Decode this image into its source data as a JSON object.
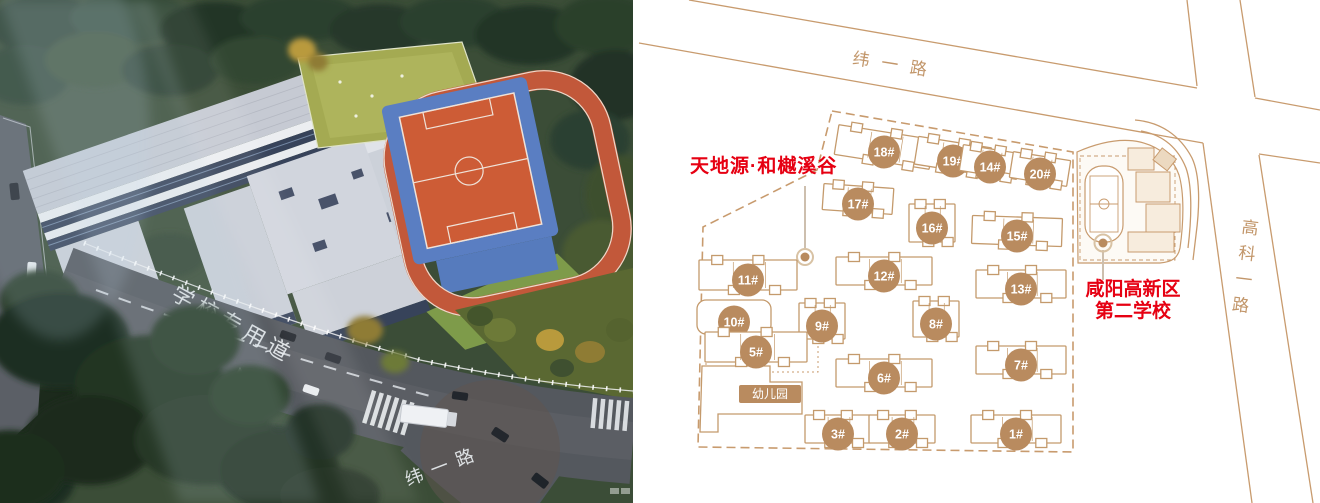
{
  "photo": {
    "road_label_main": "学校专用道",
    "road_label_bottom": "纬一路"
  },
  "plan": {
    "road_top_label": "纬一路",
    "road_right_label": "高科一路",
    "project_label": "天地源·和樾溪谷",
    "school_label_line1": "咸阳高新区",
    "school_label_line2": "第二学校",
    "kindergarten_label": "幼儿园",
    "colors": {
      "plan_line": "#c89b6e",
      "badge_fill": "#b98b5f",
      "highlight_red": "#e60012"
    },
    "buildings": [
      {
        "label": "18#",
        "x": 884,
        "y": 152,
        "w": 96,
        "h": 30,
        "rot": 9
      },
      {
        "label": "19#",
        "x": 953,
        "y": 161,
        "w": 74,
        "h": 28,
        "rot": 9
      },
      {
        "label": "14#",
        "x": 990,
        "y": 167,
        "w": 58,
        "h": 26,
        "rot": 9
      },
      {
        "label": "20#",
        "x": 1040,
        "y": 174,
        "w": 58,
        "h": 26,
        "rot": 9
      },
      {
        "label": "17#",
        "x": 858,
        "y": 204,
        "w": 70,
        "h": 26,
        "rot": 4
      },
      {
        "label": "16#",
        "x": 932,
        "y": 228,
        "w": 46,
        "h": 38,
        "rot": 0
      },
      {
        "label": "15#",
        "x": 1017,
        "y": 236,
        "w": 90,
        "h": 28,
        "rot": 2
      },
      {
        "label": "11#",
        "x": 748,
        "y": 280,
        "w": 98,
        "h": 30,
        "rot": 0
      },
      {
        "label": "12#",
        "x": 884,
        "y": 276,
        "w": 96,
        "h": 28,
        "rot": 0
      },
      {
        "label": "13#",
        "x": 1021,
        "y": 289,
        "w": 90,
        "h": 28,
        "rot": 0
      },
      {
        "label": "10#",
        "x": 734,
        "y": 322,
        "w": 74,
        "h": 34,
        "rot": 0,
        "shape": "rounded"
      },
      {
        "label": "9#",
        "x": 822,
        "y": 326,
        "w": 46,
        "h": 36,
        "rot": 0
      },
      {
        "label": "8#",
        "x": 936,
        "y": 324,
        "w": 46,
        "h": 36,
        "rot": 0
      },
      {
        "label": "5#",
        "x": 756,
        "y": 352,
        "w": 102,
        "h": 30,
        "rot": 0
      },
      {
        "label": "7#",
        "x": 1021,
        "y": 365,
        "w": 90,
        "h": 28,
        "rot": 0
      },
      {
        "label": "6#",
        "x": 884,
        "y": 378,
        "w": 96,
        "h": 28,
        "rot": 0
      },
      {
        "label": "3#",
        "x": 838,
        "y": 434,
        "w": 66,
        "h": 28,
        "rot": 0
      },
      {
        "label": "2#",
        "x": 902,
        "y": 434,
        "w": 66,
        "h": 28,
        "rot": 0
      },
      {
        "label": "1#",
        "x": 1016,
        "y": 434,
        "w": 90,
        "h": 28,
        "rot": 0
      }
    ]
  }
}
